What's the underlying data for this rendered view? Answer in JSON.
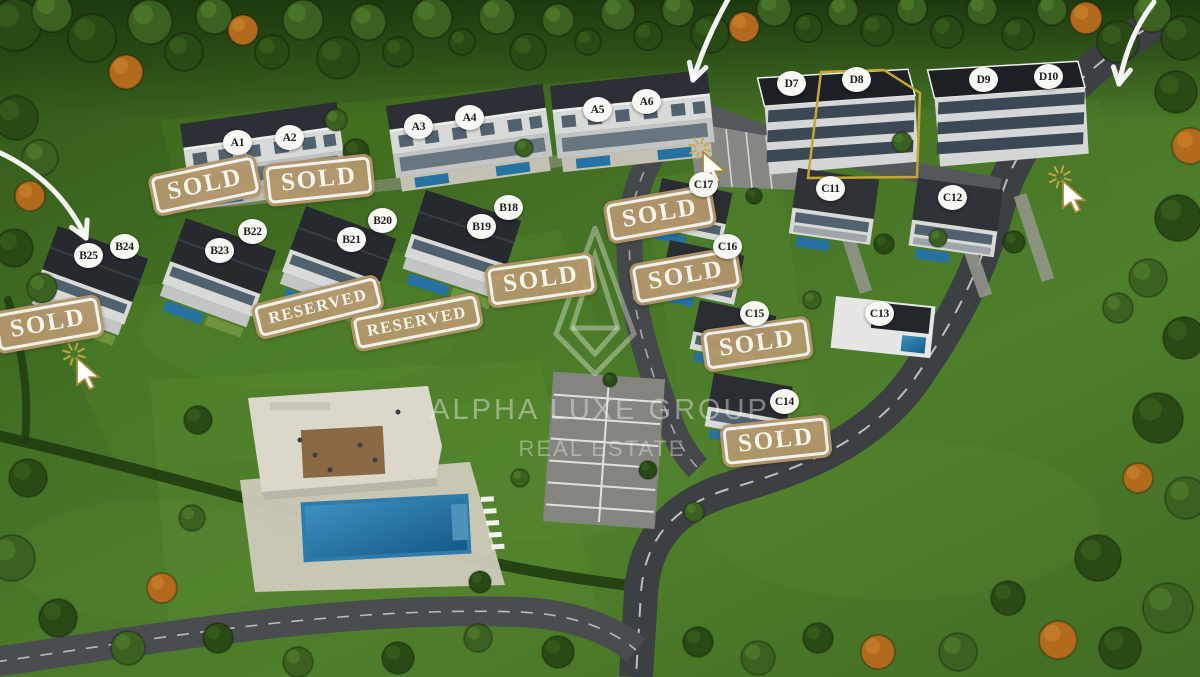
{
  "site": {
    "watermark": {
      "line1": "ALPHA LUXE GROUP",
      "line2": "REAL ESTATE"
    },
    "units": [
      {
        "id": "A1",
        "x": 237,
        "y": 143
      },
      {
        "id": "A2",
        "x": 289,
        "y": 138
      },
      {
        "id": "A3",
        "x": 418,
        "y": 127
      },
      {
        "id": "A4",
        "x": 469,
        "y": 118
      },
      {
        "id": "A5",
        "x": 597,
        "y": 110
      },
      {
        "id": "A6",
        "x": 646,
        "y": 102
      },
      {
        "id": "B18",
        "x": 508,
        "y": 208
      },
      {
        "id": "B19",
        "x": 481,
        "y": 227
      },
      {
        "id": "B20",
        "x": 382,
        "y": 221
      },
      {
        "id": "B21",
        "x": 351,
        "y": 240
      },
      {
        "id": "B22",
        "x": 252,
        "y": 232
      },
      {
        "id": "B23",
        "x": 219,
        "y": 251
      },
      {
        "id": "B24",
        "x": 124,
        "y": 247
      },
      {
        "id": "B25",
        "x": 88,
        "y": 256
      },
      {
        "id": "C11",
        "x": 830,
        "y": 189
      },
      {
        "id": "C12",
        "x": 952,
        "y": 198
      },
      {
        "id": "C13",
        "x": 879,
        "y": 314
      },
      {
        "id": "C14",
        "x": 784,
        "y": 402
      },
      {
        "id": "C15",
        "x": 754,
        "y": 314
      },
      {
        "id": "C16",
        "x": 727,
        "y": 247
      },
      {
        "id": "C17",
        "x": 703,
        "y": 185
      },
      {
        "id": "D7",
        "x": 791,
        "y": 84
      },
      {
        "id": "D8",
        "x": 856,
        "y": 80
      },
      {
        "id": "D9",
        "x": 983,
        "y": 80
      },
      {
        "id": "D10",
        "x": 1048,
        "y": 77
      }
    ],
    "badges": [
      {
        "text": "SOLD",
        "x": 205,
        "y": 185,
        "rot": -12
      },
      {
        "text": "SOLD",
        "x": 319,
        "y": 180,
        "rot": -6
      },
      {
        "text": "SOLD",
        "x": 541,
        "y": 280,
        "rot": -8
      },
      {
        "text": "RESERVED",
        "x": 318,
        "y": 307,
        "rot": -14
      },
      {
        "text": "RESERVED",
        "x": 417,
        "y": 322,
        "rot": -11
      },
      {
        "text": "SOLD",
        "x": 48,
        "y": 324,
        "rot": -10
      },
      {
        "text": "SOLD",
        "x": 660,
        "y": 214,
        "rot": -10
      },
      {
        "text": "SOLD",
        "x": 686,
        "y": 276,
        "rot": -10
      },
      {
        "text": "SOLD",
        "x": 757,
        "y": 344,
        "rot": -8
      },
      {
        "text": "SOLD",
        "x": 776,
        "y": 441,
        "rot": -6
      }
    ],
    "highlight": {
      "unit": "D8",
      "points": "821,72 884,70 920,93 917,177 808,178",
      "color": "#c8a62e"
    },
    "arrows": [
      {
        "x1": -6,
        "y1": 150,
        "cx": 58,
        "cy": 178,
        "x2": 86,
        "y2": 238
      },
      {
        "x1": 731,
        "y1": -6,
        "cx": 706,
        "cy": 38,
        "x2": 693,
        "y2": 80
      },
      {
        "x1": 1154,
        "y1": 2,
        "cx": 1128,
        "cy": 36,
        "x2": 1119,
        "y2": 84
      }
    ],
    "cursors": [
      {
        "x": 74,
        "y": 354
      },
      {
        "x": 700,
        "y": 148
      },
      {
        "x": 1060,
        "y": 177
      }
    ],
    "colors": {
      "badge_bg": "#b3976b",
      "badge_text": "#fdfbf3",
      "marker_bg": "#f8f8f5",
      "marker_text": "#1c1c1c",
      "highlight": "#c8a62e",
      "arrow": "#ffffff",
      "cursor_gold": "#caa64d"
    }
  }
}
